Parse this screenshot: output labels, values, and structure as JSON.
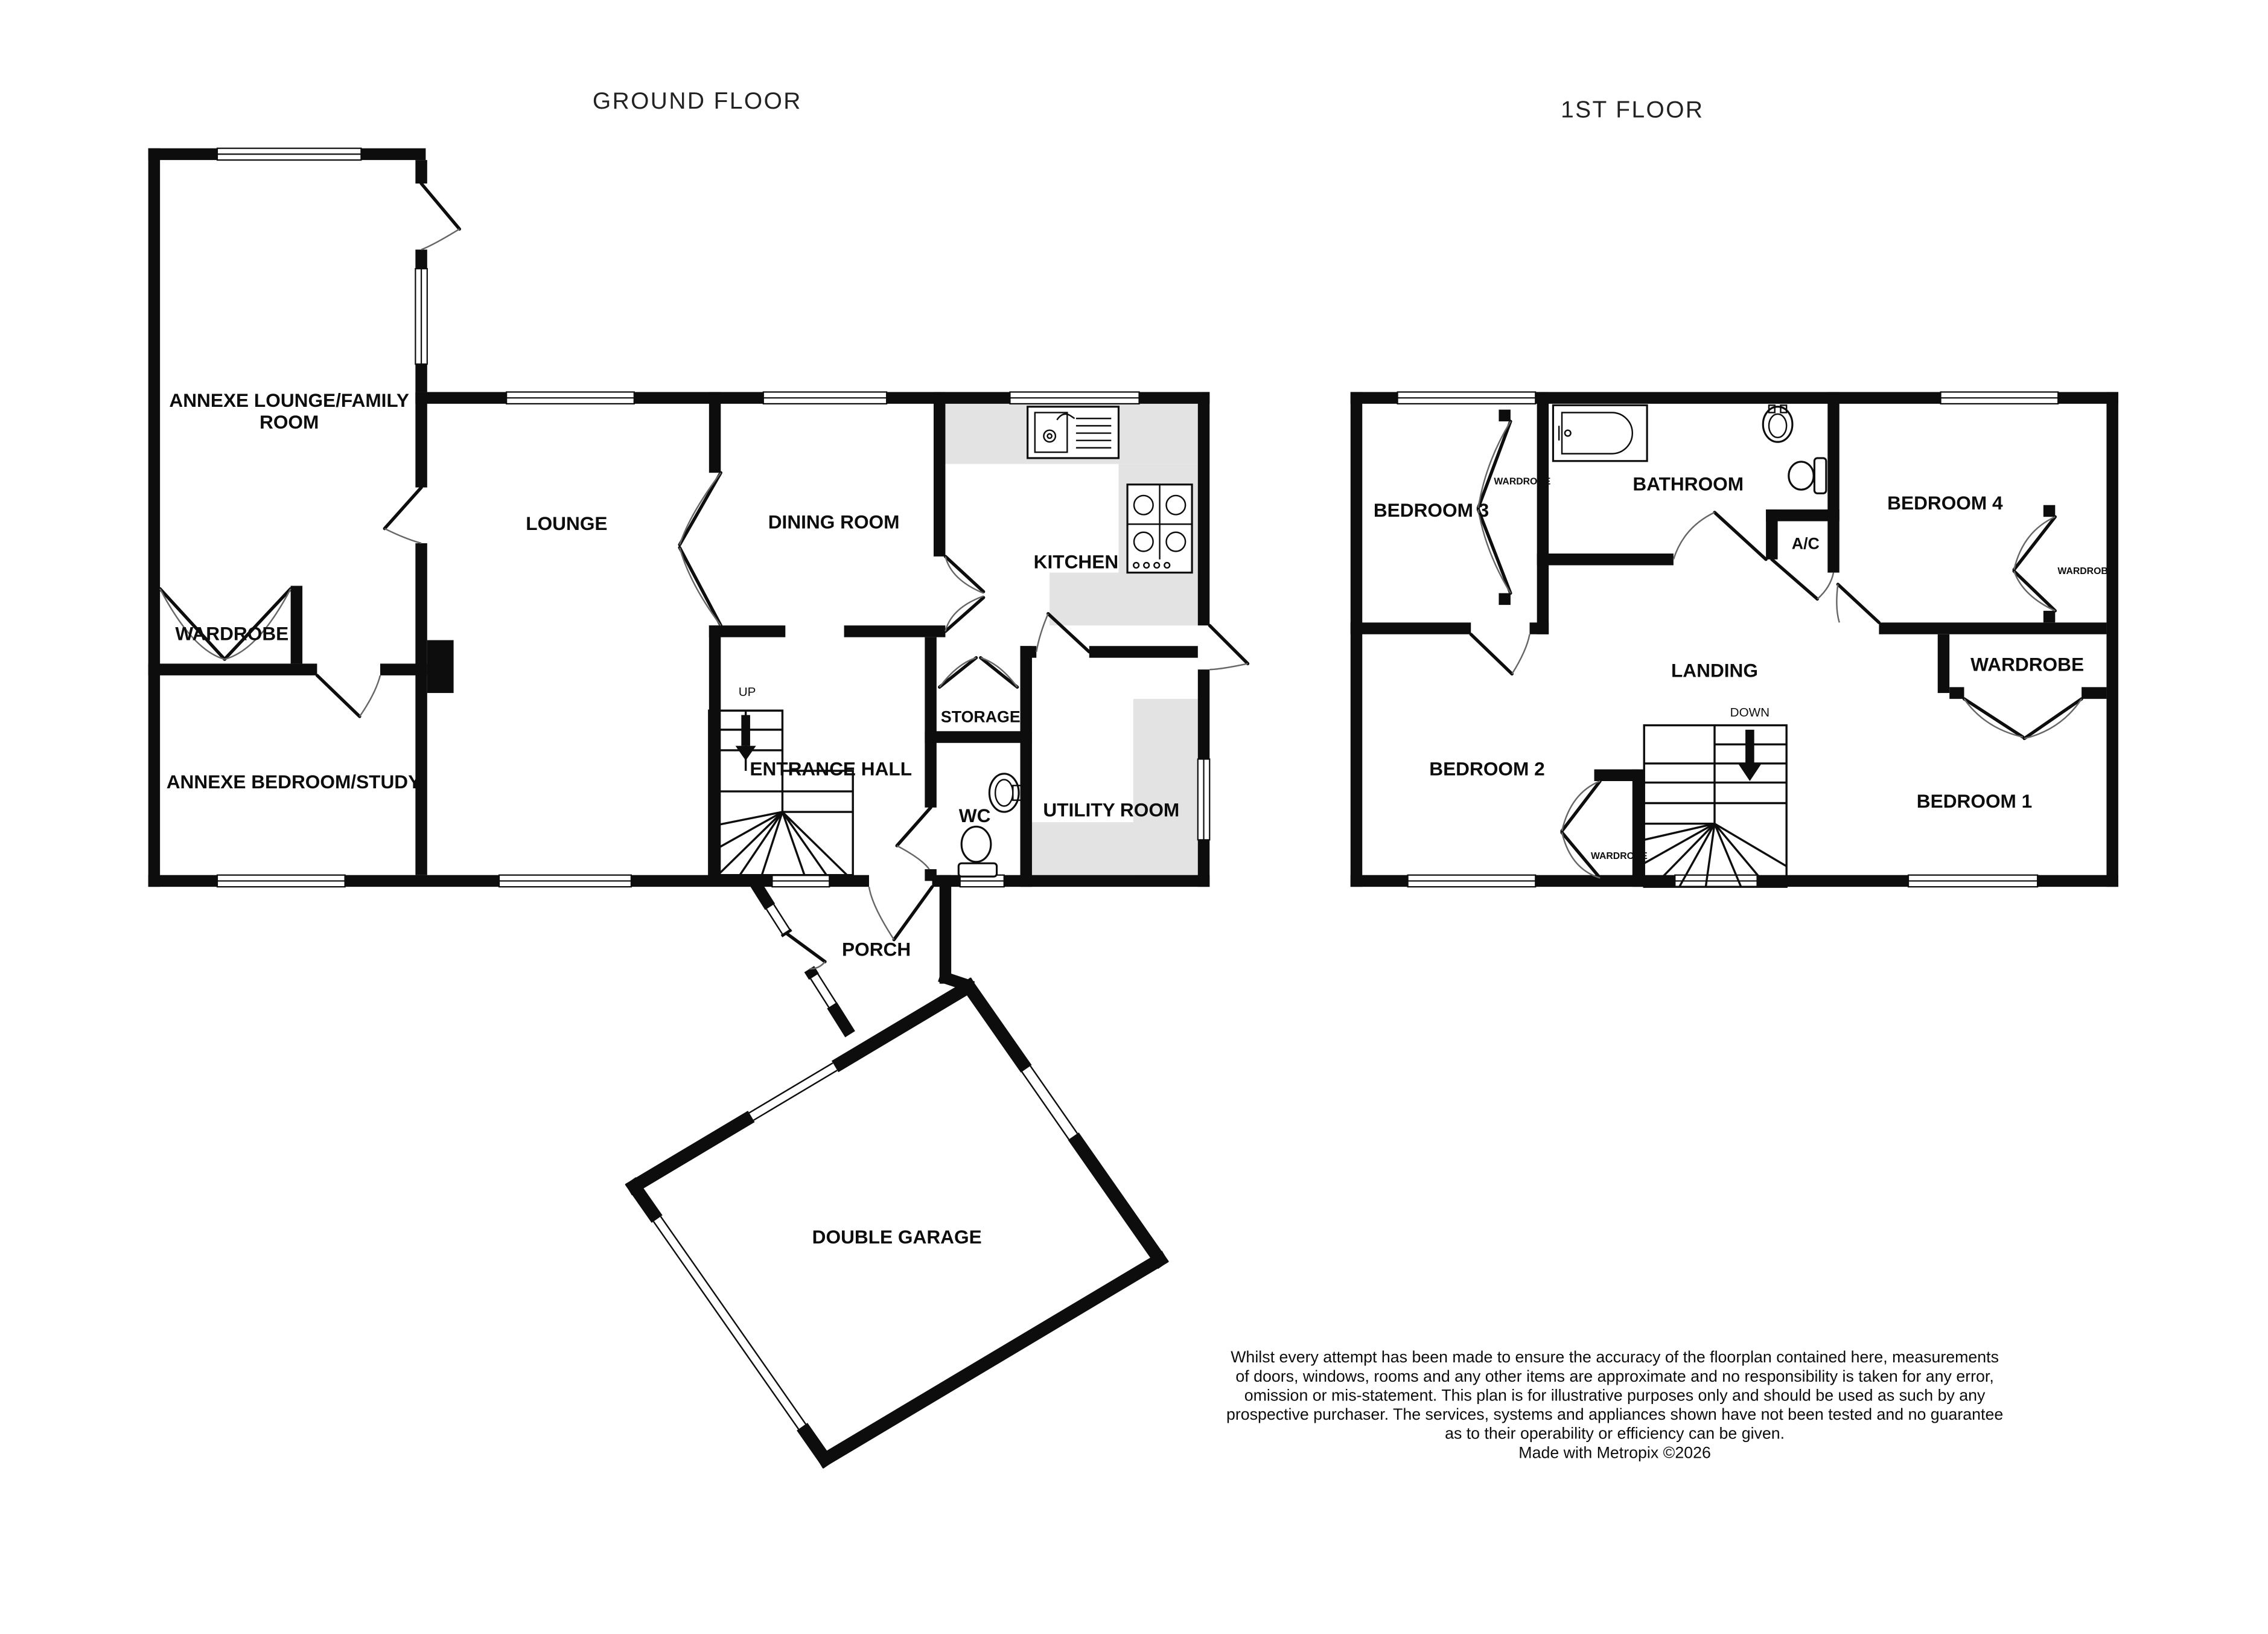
{
  "titles": {
    "ground": "GROUND FLOOR",
    "first": "1ST FLOOR"
  },
  "colors": {
    "wall": "#0d0d0d",
    "counter": "#e3e3e3",
    "background": "#ffffff"
  },
  "ground_floor": {
    "annexe_lounge_line1": "ANNEXE LOUNGE/FAMILY",
    "annexe_lounge_line2": "ROOM",
    "wardrobe": "WARDROBE",
    "annexe_bedroom": "ANNEXE BEDROOM/STUDY",
    "lounge": "LOUNGE",
    "dining": "DINING ROOM",
    "kitchen": "KITCHEN",
    "entrance_hall": "ENTRANCE HALL",
    "up": "UP",
    "storage": "STORAGE",
    "wc": "WC",
    "utility": "UTILITY ROOM",
    "porch": "PORCH",
    "garage": "DOUBLE GARAGE"
  },
  "first_floor": {
    "bedroom3": "BEDROOM 3",
    "wardrobe3": "WARDROBE",
    "bathroom": "BATHROOM",
    "bedroom4": "BEDROOM 4",
    "wardrobe4": "WARDROBE",
    "ac": "A/C",
    "landing": "LANDING",
    "down": "DOWN",
    "wardrobe_big": "WARDROBE",
    "bedroom2": "BEDROOM 2",
    "wardrobe2": "WARDROBE",
    "bedroom1": "BEDROOM 1"
  },
  "disclaimer": {
    "lines": [
      "Whilst every attempt has been made to ensure the accuracy of the floorplan contained here, measurements",
      "of doors, windows, rooms and any other items are approximate and no responsibility is taken for any error,",
      "omission or mis-statement. This plan is for illustrative purposes only and should be used as such by any",
      "prospective purchaser. The services, systems and appliances shown have not been tested and no guarantee",
      "as to their operability or efficiency can be given.",
      "Made with Metropix ©2026"
    ]
  }
}
